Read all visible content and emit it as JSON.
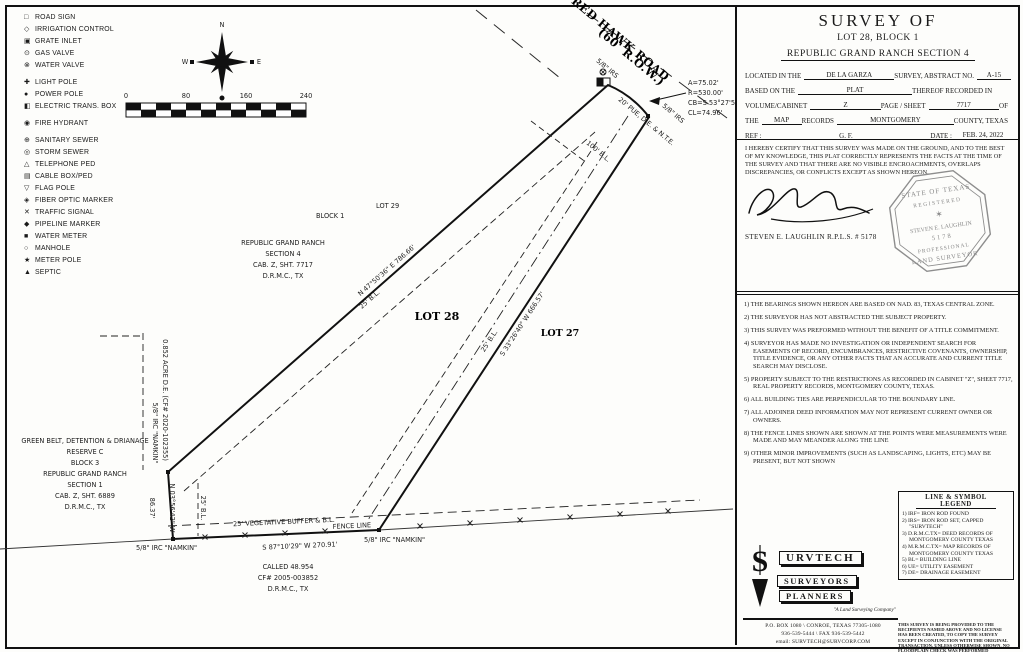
{
  "symbol_legend": {
    "items": [
      {
        "icon": "□",
        "label": "ROAD SIGN"
      },
      {
        "icon": "◇",
        "label": "IRRIGATION CONTROL"
      },
      {
        "icon": "▣",
        "label": "GRATE INLET"
      },
      {
        "icon": "⊙",
        "label": "GAS VALVE"
      },
      {
        "icon": "⊗",
        "label": "WATER VALVE"
      },
      {
        "icon": "✚",
        "label": "LIGHT POLE"
      },
      {
        "icon": "●",
        "label": "POWER POLE"
      },
      {
        "icon": "◧",
        "label": "ELECTRIC TRANS. BOX"
      },
      {
        "icon": "◉",
        "label": "FIRE HYDRANT"
      },
      {
        "icon": "⊕",
        "label": "SANITARY SEWER"
      },
      {
        "icon": "◎",
        "label": "STORM SEWER"
      },
      {
        "icon": "△",
        "label": "TELEPHONE PED"
      },
      {
        "icon": "▤",
        "label": "CABLE BOX/PED"
      },
      {
        "icon": "▽",
        "label": "FLAG POLE"
      },
      {
        "icon": "◈",
        "label": "FIBER OPTIC MARKER"
      },
      {
        "icon": "✕",
        "label": "TRAFFIC SIGNAL"
      },
      {
        "icon": "◆",
        "label": "PIPELINE MARKER"
      },
      {
        "icon": "■",
        "label": "WATER METER"
      },
      {
        "icon": "○",
        "label": "MANHOLE"
      },
      {
        "icon": "★",
        "label": "METER POLE"
      },
      {
        "icon": "▲",
        "label": "SEPTIC"
      }
    ]
  },
  "compass": {
    "n": "N",
    "e": "E",
    "s": "S",
    "w": "W"
  },
  "scale_bar": {
    "t0": "0",
    "t1": "80",
    "t2": "160",
    "t3": "240"
  },
  "map": {
    "road": {
      "name": "RED HAWK ROAD",
      "row": "(60' R.O.W.)"
    },
    "curve": {
      "a": "A=75.02'",
      "r": "R=530.00'",
      "cb": "CB=S 53°27'56\" E",
      "cl": "CL=74.96'"
    },
    "markers": {
      "irs_top": "5/8\" IRS",
      "irs_east": "5/8\" IRS",
      "irc_west": "5/8\" IRC \"NAMKIN\"",
      "irc_south_left": "5/8\" IRC \"NAMKIN\"",
      "irc_south_right": "5/8\" IRC \"NAMKIN\""
    },
    "bearings": {
      "nw": "N 47°50'36\" E  786.66'",
      "se": "S 33°26'40\" W  666.57'",
      "south": "S 87°10'29\" W  270.91'",
      "west": "N 03°56'42\" W",
      "west_dist": "86.37'"
    },
    "easements": {
      "pue": "20' PUE, D.E. & N.T.E.",
      "bl100": "100' B.L.",
      "bl25_nw": "25' B.L.",
      "bl25_se": "25' B.L.",
      "bl25_w": "25' B.L.",
      "de_area": "0.852 ACRE D.E. (CF# 2020-102355)",
      "buffer": "25' VEGETATIVE BUFFER & B.L.",
      "fence": "FENCE LINE"
    },
    "lots": {
      "lot29": "LOT 29",
      "block1": "BLOCK 1",
      "lot28": "LOT 28",
      "lot27": "LOT 27"
    },
    "subdivision": {
      "l1": "REPUBLIC GRAND RANCH",
      "l2": "SECTION 4",
      "l3": "CAB. Z, SHT. 7717",
      "l4": "D.R.M.C., TX"
    },
    "greenbelt": {
      "l1": "GREEN BELT, DETENTION & DRIANAGE",
      "l2": "RESERVE C",
      "l3": "BLOCK 3",
      "l4": "REPUBLIC GRAND RANCH",
      "l5": "SECTION 1",
      "l6": "CAB. Z, SHT. 6889",
      "l7": "D.R.M.C., TX"
    },
    "adjoiner": {
      "l1": "CALLED 48.954",
      "l2": "CF# 2005-003852",
      "l3": "D.R.M.C., TX"
    }
  },
  "title_block": {
    "t1": "SURVEY OF",
    "t2": "LOT 28, BLOCK 1",
    "t3": "REPUBLIC GRAND RANCH SECTION 4",
    "l1a": "LOCATED IN THE",
    "v1a": "DE LA GARZA",
    "l1b": "SURVEY, ABSTRACT NO.",
    "v1b": "A-15",
    "l2a": "BASED ON THE",
    "v2a": "PLAT",
    "l2b": "THEREOF RECORDED IN",
    "l3a": "VOLUME/CABINET",
    "v3a": "Z",
    "l3b": "PAGE / SHEET",
    "v3b": "7717",
    "l3c": "OF",
    "l4a": "THE",
    "v4a": "MAP",
    "l4b": "RECORDS",
    "v4b": "MONTGOMERY",
    "l4c": "COUNTY, TEXAS",
    "l5a": "REF :",
    "v5a": " ",
    "l5b": "G. F.",
    "v5b": " ",
    "l5c": "DATE :",
    "v5c": "FEB. 24, 2022"
  },
  "certification": {
    "text": "I HEREBY CERTIFY THAT THIS SURVEY WAS MADE ON THE GROUND, AND TO THE BEST OF MY KNOWLEDGE, THIS PLAT CORRECTLY REPRESENTS THE FACTS AT THE TIME OF THE SURVEY AND THAT THERE ARE NO VISIBLE ENCROACHMENTS, OVERLAPS DISCREPANCIES, OR CONFLICTS EXCEPT AS SHOWN HEREON.",
    "surveyor": "STEVEN E. LAUGHLIN  R.P.L.S. # 5178"
  },
  "stamp": {
    "l1": "STATE OF TEXAS",
    "l2": "REGISTERED",
    "star": "✶",
    "l3": "STEVEN E. LAUGHLIN",
    "l4": "5178",
    "l5": "PROFESSIONAL",
    "l6": "LAND SURVEYOR"
  },
  "notes": {
    "n1": "1) THE BEARINGS SHOWN HEREON ARE BASED ON NAD. 83, TEXAS CENTRAL ZONE.",
    "n2": "2) THE SURVEYOR HAS NOT ABSTRACTED THE SUBJECT PROPERTY.",
    "n3": "3) THIS SURVEY WAS PREFORMED WITHOUT THE BENEFIT OF A TITLE COMMITMENT.",
    "n4": "4) SURVEYOR HAS MADE NO INVESTIGATION OR INDEPENDENT SEARCH FOR EASEMENTS OF RECORD, ENCUMBRANCES, RESTRICTIVE COVENANTS, OWNERSHIP, TITLE EVIDENCE, OR ANY OTHER FACTS THAT AN ACCURATE AND CURRENT TITLE SEARCH MAY DISCLOSE.",
    "n5": "5) PROPERTY SUBJECT TO THE RESTRICTIONS AS RECORDED IN CABINET \"Z\", SHEET 7717, REAL PROPERTY RECORDS, MONTGOMERY COUNTY, TEXAS.",
    "n6": "6) ALL BUILDING TIES ARE PERPENDICULAR TO THE BOUNDARY LINE.",
    "n7": "7) ALL ADJOINER DEED INFORMATION MAY NOT REPRESENT CURRENT OWNER OR OWNERS.",
    "n8": "8) THE FENCE LINES SHOWN ARE SHOWN AT THE POINTS WERE MEASUREMENTS WERE MADE AND MAY MEANDER ALONG THE LINE",
    "n9": "9) OTHER MINOR IMPROVEMENTS (SUCH AS LANDSCAPING, LIGHTS, ETC) MAY BE PRESENT, BUT NOT SHOWN"
  },
  "line_legend": {
    "t1": "LINE & SYMBOL",
    "t2": "LEGEND",
    "i1": "1) IRF= IRON ROD FOUND",
    "i2": "2) IRS= IRON ROD SET, CAPPED \"SURVTECH\"",
    "i3": "3) D.R.M.C.TX= DEED RECORDS OF MONTGOMERY COUNTY TEXAS",
    "i4": "4) M.R.M.C.TX= MAP RECORDS OF MONTGOMERY COUNTY TEXAS",
    "i5": "5) BL= BUILDING LINE",
    "i6": "6) UE= UTILITY EASEMENT",
    "i7": "7) DE= DRAINAGE EASEMENT",
    "disclaimer": "THIS SURVEY IS BEING PROVIDED TO THE RECIPIENTS NAMED ABOVE AND NO LICENSE HAS BEEN CREATED, TO COPY THE SURVEY EXCEPT IN CONJUNCTION WITH THE ORIGINAL TRANSACTION. UNLESS OTHERWISE SHOWN, NO FLOODPLAIN CHECK WAS PERFORMED"
  },
  "company": {
    "glyph": "S",
    "name_rest": "URVTECH",
    "badge1": "SURVEYORS",
    "badge2": "PLANNERS",
    "tagline": "\"A Land Surveying Company\"",
    "addr1": "P.O. BOX 1080 \\ CONROE, TEXAS 77305-1080",
    "addr2": "936-539-5444 \\ FAX 936-539-5442",
    "addr3": "email: SURVTECH@SURVCORP.COM"
  }
}
